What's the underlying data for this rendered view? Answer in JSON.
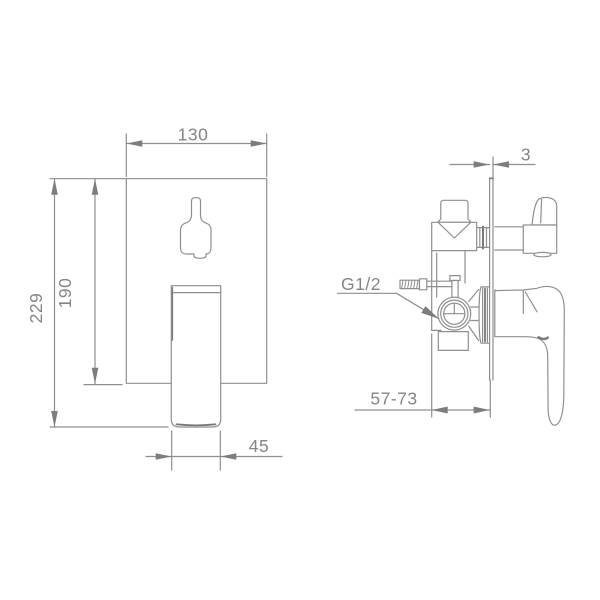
{
  "drawing": {
    "type": "technical-dimension-drawing",
    "subject": "concealed shower mixer valve, front and side views",
    "dimensions": {
      "width": "130",
      "plate_height": "190",
      "total_height": "229",
      "handle_width": "45",
      "plate_thickness": "3",
      "install_depth": "57-73",
      "thread": "G1/2"
    },
    "colors": {
      "line": "#8f8f8f",
      "dark_line": "#7a7a7a",
      "text": "#858585",
      "arrow": "#7d7d7d",
      "background": "#ffffff"
    }
  }
}
